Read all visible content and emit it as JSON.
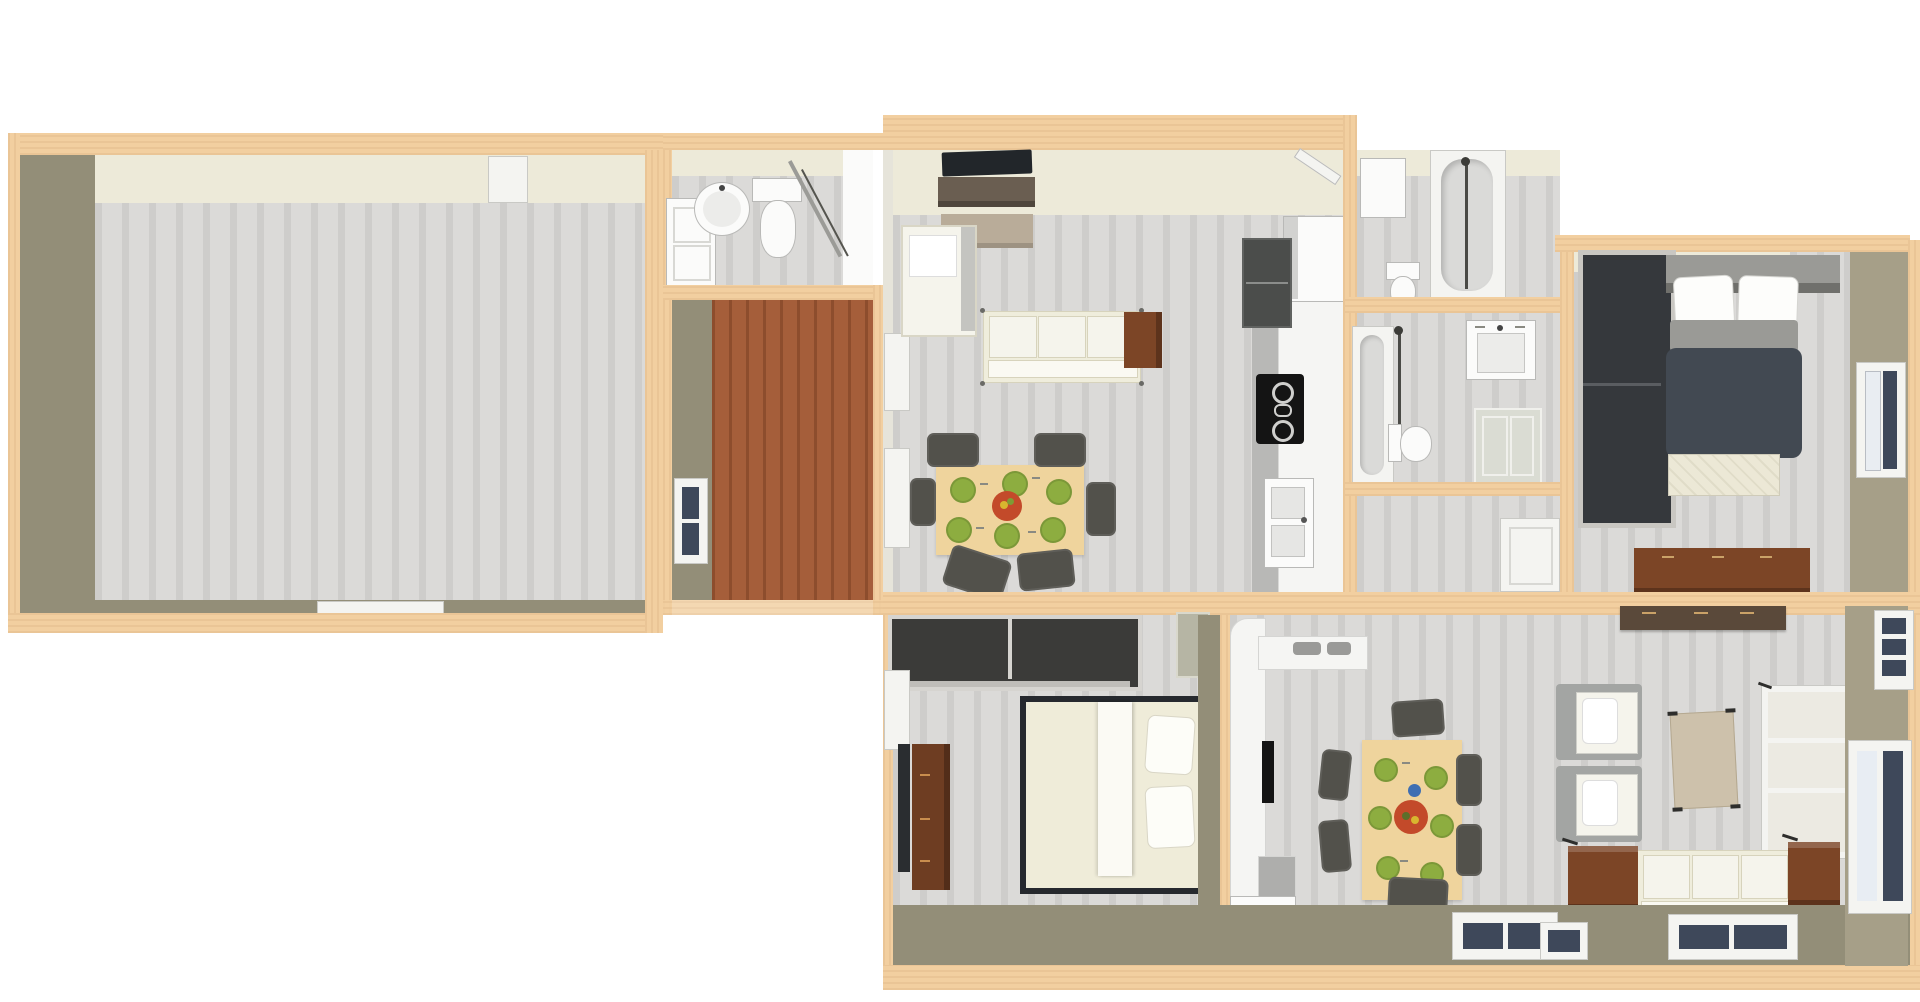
{
  "meta": {
    "title": "3D apartment floor plan render",
    "view": "top-down dollhouse render, no visible text",
    "background": "#ffffff"
  },
  "colors": {
    "bg": "#ffffff",
    "wall_top": "#f2cfa0",
    "wall_dark": "#938e78",
    "wall_cream": "#edead9",
    "wall_tan": "#a69f88",
    "floor_a": "#dbdad8",
    "floor_b": "#cecdcb",
    "floor_brown_a": "#a55e3a",
    "floor_brown_b": "#8d4d2d",
    "sofa": "#efeddc",
    "sofa_edge": "#d7d3bc",
    "cushion": "#f5f4ec",
    "armchair_gray": "#a3a5a3",
    "tv": "#22262a",
    "tv_stand": "#6a5e51",
    "coffee": "#b9ac99",
    "table_wood": "#efd49d",
    "plate": "#8dad40",
    "bowl": "#c34a2a",
    "chair": "#52514b",
    "counter": "#f5f5f3",
    "counter_edge": "#b8b8b6",
    "cab_dark": "#4b4d4b",
    "cooktop": "#141414",
    "fixture": "#fbfbfa",
    "fixture_inner": "#dadad8",
    "fixture_shadow": "#b9b9b7",
    "glass": "#3e485a",
    "frame": "#f4f4f1",
    "duvet": "#424952",
    "bed_gray": "#9a9a96",
    "bed_cream": "#efecd9",
    "wardrobe": "#35383c",
    "wardrobe_frame": "#c9c7c2",
    "wood": "#7c4526",
    "wood_dark": "#6e3d22",
    "walnut": "#5a493a",
    "closet_dark": "#3b3b39",
    "metal": "#77776f",
    "blue_plate": "#3f6fb2"
  },
  "rooms": {
    "studio": {
      "label": "Large empty room"
    },
    "entry_bath": {
      "label": "Small bathroom with round basin"
    },
    "entry_hall": {
      "label": "Entry hall with brown wood floor"
    },
    "living_a": {
      "label": "Living and dining room, unit A"
    },
    "kitchen_a": {
      "label": "Galley kitchen, unit A"
    },
    "bath_1": {
      "label": "Bathroom with shower tub"
    },
    "bath_2": {
      "label": "Bathroom with bathtub and sink"
    },
    "hall_closet": {
      "label": "Hallway closet area"
    },
    "bedroom_a": {
      "label": "Bedroom with dark double bed"
    },
    "bedroom_b": {
      "label": "Bedroom with cream double bed"
    },
    "kitchen_b": {
      "label": "L-shaped kitchen, unit B"
    },
    "dining_b": {
      "label": "Dining area, unit B"
    },
    "living_b": {
      "label": "Living room, unit B"
    }
  },
  "furniture": {
    "tv_a": {
      "label": "Flat screen TV"
    },
    "tv_stand_a": {
      "label": "TV cabinet"
    },
    "coffee_a": {
      "label": "Coffee table"
    },
    "armchair_a": {
      "label": "Cream armchair"
    },
    "sofa_a": {
      "label": "Cream three-seat sofa"
    },
    "side_table_a": {
      "label": "Brown side table"
    },
    "table_a": {
      "label": "Dining table with six green plates and fruit bowl"
    },
    "fridge_a": {
      "label": "Refrigerator"
    },
    "cabinet_a": {
      "label": "Dark upper cabinet"
    },
    "cooktop_a": {
      "label": "Black cooktop with oven"
    },
    "sink_a": {
      "label": "Double kitchen sink"
    },
    "vanity_1": {
      "label": "Bathroom vanity cabinet"
    },
    "basin_1": {
      "label": "Round wash basin"
    },
    "toilet_1": {
      "label": "Toilet"
    },
    "shower_1": {
      "label": "Corner shower with glass door"
    },
    "cabinet_b1": {
      "label": "Wall cabinet"
    },
    "toilet_b1": {
      "label": "Toilet"
    },
    "tub_b1": {
      "label": "Bathtub with shower column"
    },
    "door_b1": {
      "label": "Open bathroom door"
    },
    "tub_b2": {
      "label": "Bathtub with shower column"
    },
    "toilet_b2": {
      "label": "Toilet"
    },
    "sink_b2": {
      "label": "Wall-hung wash basin"
    },
    "cabinet_b2": {
      "label": "Bathroom cabinet"
    },
    "closet_door": {
      "label": "White closet door panel"
    },
    "wardrobe_a": {
      "label": "Dark two-door wardrobe"
    },
    "bed_a": {
      "label": "Double bed with dark duvet"
    },
    "bench_a": {
      "label": "Quilted bench"
    },
    "dresser_a": {
      "label": "Brown dresser"
    },
    "window_a": {
      "label": "Bedroom window"
    },
    "closet_b": {
      "label": "Built-in closet with dark interior"
    },
    "bed_b": {
      "label": "Double bed with cream duvet"
    },
    "dresser_b": {
      "label": "Brown dresser with TV"
    },
    "cabinet_ne": {
      "label": "Wall cupboard"
    },
    "counter_b": {
      "label": "L-shaped kitchen counter"
    },
    "oven_b": {
      "label": "Built-in black oven"
    },
    "table_b": {
      "label": "Dining table with six green plates, fruit bowl and blue plate"
    },
    "shelf_b": {
      "label": "Dark wood wall shelf"
    },
    "armchair_b1": {
      "label": "Gray armchair"
    },
    "armchair_b2": {
      "label": "Gray armchair"
    },
    "coffee_b": {
      "label": "Light wood coffee table"
    },
    "bookshelf_b": {
      "label": "White open bookshelf"
    },
    "sofa_b": {
      "label": "Cream three-seat sofa"
    },
    "cube_1": {
      "label": "Brown cube side table"
    },
    "cube_2": {
      "label": "Brown cube side table"
    },
    "window_s1": {
      "label": "South window"
    },
    "window_s2": {
      "label": "South window"
    },
    "window_s3": {
      "label": "South window"
    },
    "window_e1": {
      "label": "East window"
    },
    "door_e": {
      "label": "Sliding glass door"
    },
    "window_h": {
      "label": "Hall window"
    },
    "window_w1": {
      "label": "West window"
    },
    "window_w2": {
      "label": "West window"
    },
    "window_bb": {
      "label": "Bedroom window"
    },
    "door_n": {
      "label": "Door on north wall"
    },
    "window_st": {
      "label": "Window on south wall"
    }
  }
}
